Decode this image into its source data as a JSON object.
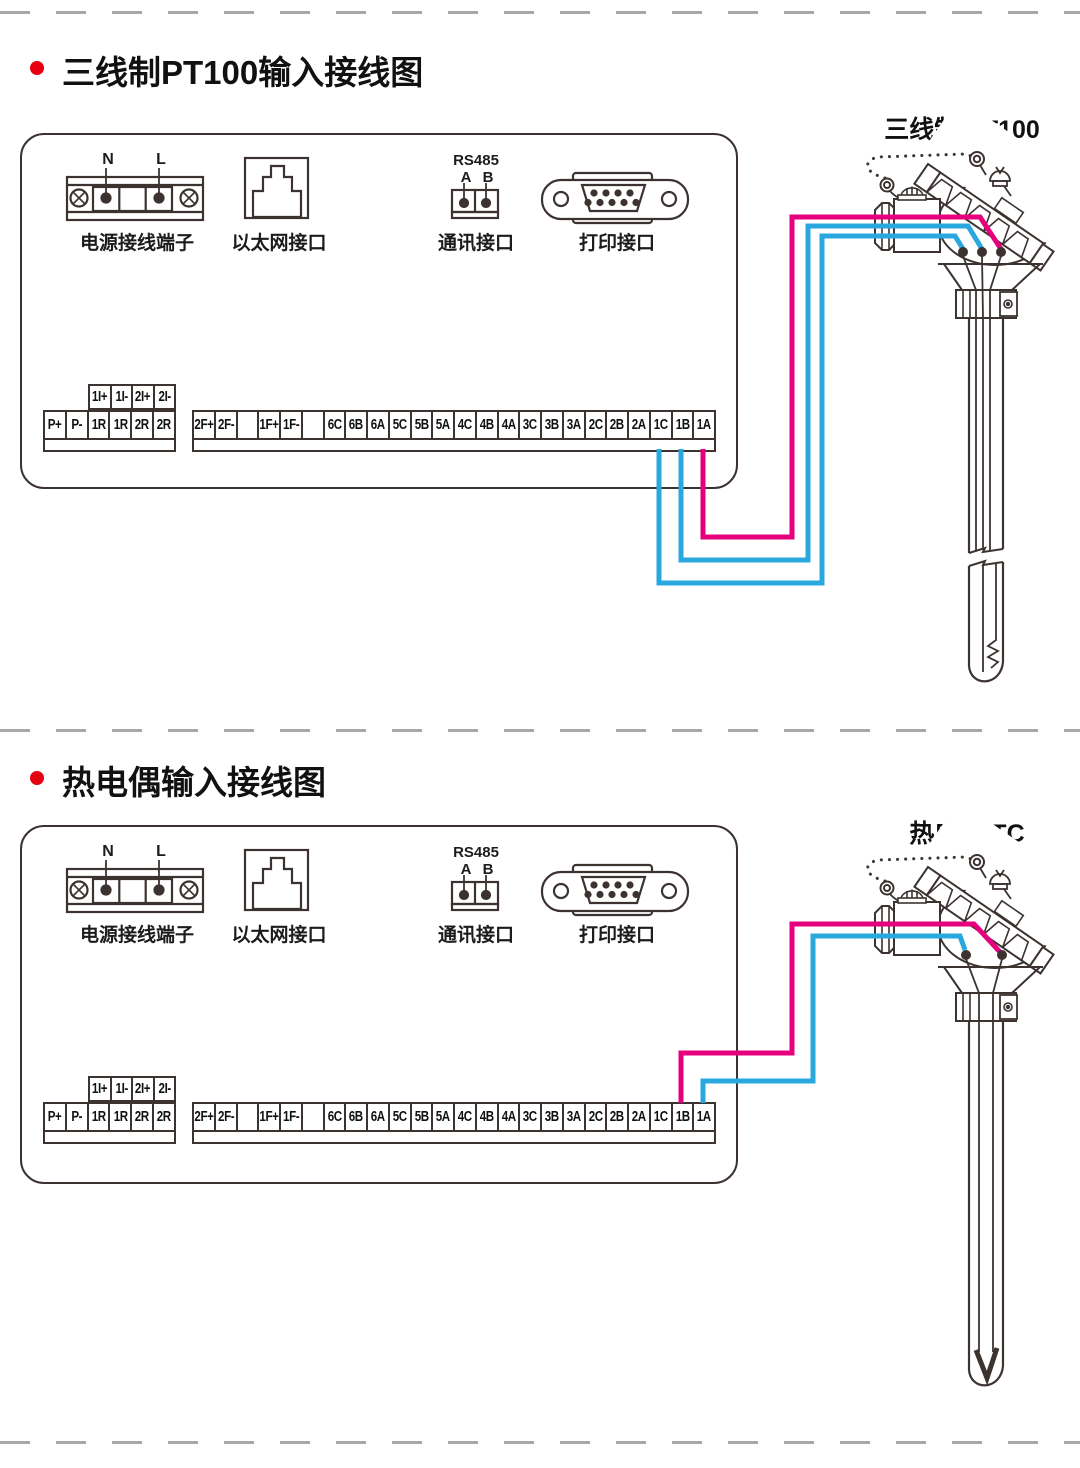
{
  "colors": {
    "wire_magenta": "#e6007e",
    "wire_blue": "#29a8e0",
    "line": "#3c3331",
    "divider": "#a8a8a8",
    "bullet": "#e60012",
    "text": "#111111"
  },
  "sections": [
    {
      "title": "三线制PT100输入接线图",
      "sensor_label": "三线制 PT100",
      "sensor_type": "RTD"
    },
    {
      "title": "热电偶输入接线图",
      "sensor_label": "热电偶 TC",
      "sensor_type": "thermocouple"
    }
  ],
  "panel": {
    "power": {
      "caption": "电源接线端子",
      "terminals": {
        "neutral": "N",
        "live": "L"
      }
    },
    "ethernet": {
      "caption": "以太网接口"
    },
    "comm": {
      "caption": "通讯接口",
      "bus": "RS485",
      "pin_a": "A",
      "pin_b": "B"
    },
    "printer": {
      "caption": "打印接口"
    },
    "strip": {
      "upper_row": [
        "1I+",
        "1I-",
        "2I+",
        "2I-"
      ],
      "left_block": [
        "P+",
        "P-",
        "1R",
        "1R",
        "2R",
        "2R"
      ],
      "right_block": [
        "2F+",
        "2F-",
        "",
        "1F+",
        "1F-",
        "",
        "6C",
        "6B",
        "6A",
        "5C",
        "5B",
        "5A",
        "4C",
        "4B",
        "4A",
        "3C",
        "3B",
        "3A",
        "2C",
        "2B",
        "2A",
        "1C",
        "1B",
        "1A"
      ]
    }
  },
  "wiring": {
    "pt100": {
      "1A": "magenta",
      "1B": "blue",
      "1C": "blue"
    },
    "tc": {
      "1B": "magenta",
      "1A": "blue"
    }
  }
}
